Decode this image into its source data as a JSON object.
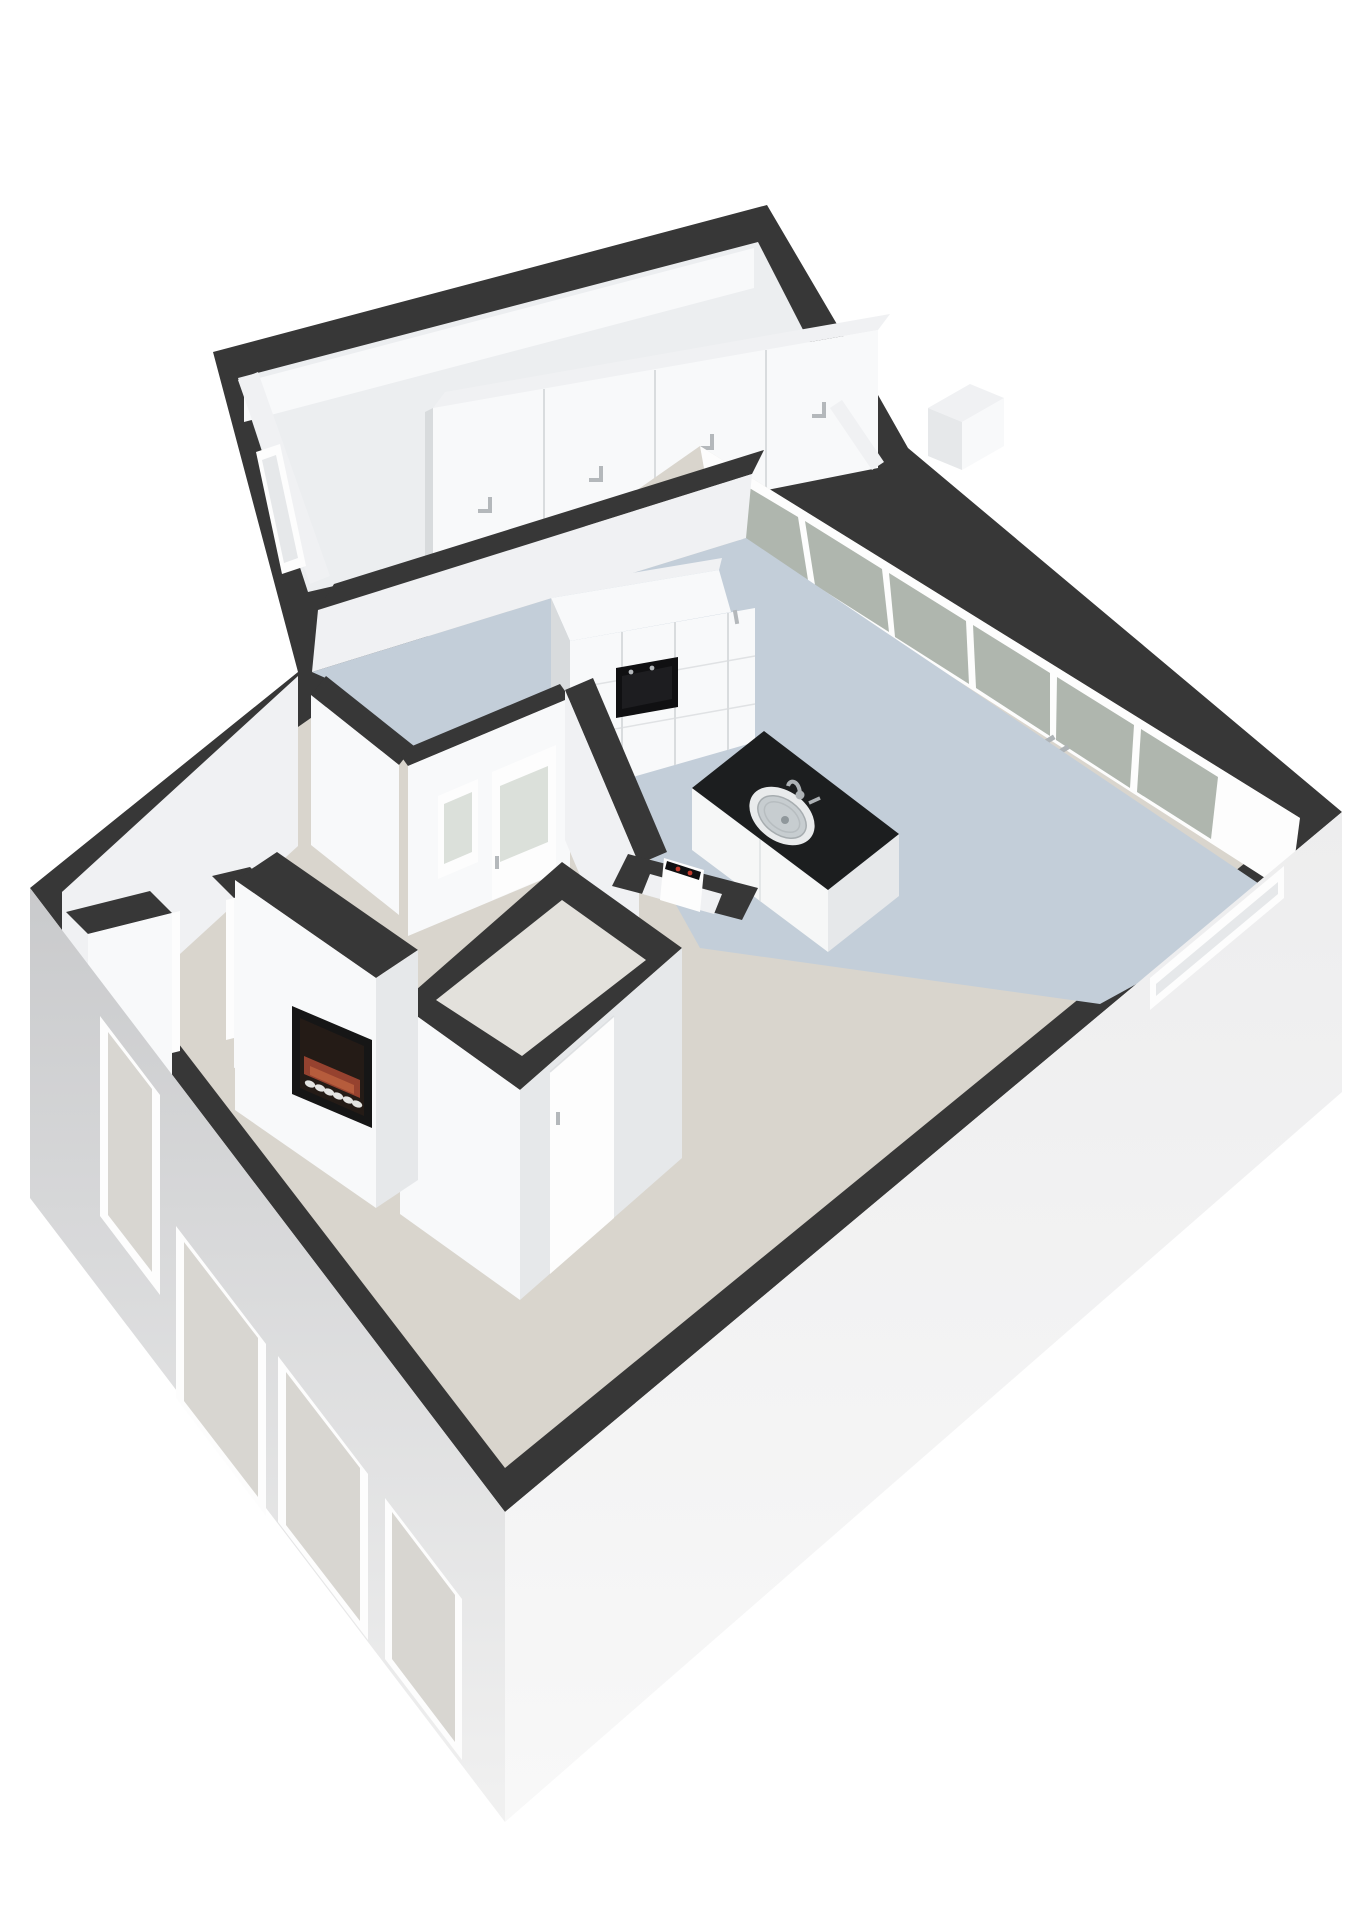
{
  "meta": {
    "render_type": "3d-floorplan-isometric-render",
    "has_text": false
  },
  "colors": {
    "background": "#ffffff",
    "wall_cap": "#373737",
    "wall_face_bright": "#f8f9fa",
    "wall_face_light": "#f0f1f3",
    "wall_face_shade": "#e6e8ea",
    "wall_face_dark": "#d8dbdd",
    "annex_floor": "#eceef0",
    "kitchen_floor": "#c3ced9",
    "living_floor": "#d9d5cd",
    "bath_floor": "#e3e1dc",
    "exterior_wall_top": "#c9cacc",
    "exterior_wall_bottom": "#f1f1f1",
    "exterior_wall_bright": "#f8f8f8",
    "glass_pane": "#afb6ae",
    "window_pane": "#d8d6d1",
    "window_frosted": "#dbe0da",
    "frame_white": "#fdfdfd",
    "seam": "#d9dcde",
    "handle": "#b4b8bb",
    "metal": "#aeb3b6",
    "island_top": "#1c1e1f",
    "island_base": "#f6f7f7",
    "oven_black": "#101012",
    "oven_glass": "#1d1d20",
    "fire_frame": "#161616",
    "fire_inner": "#241b16",
    "fire_flame": "#96422f",
    "fire_flame_hot": "#b65c3c",
    "fire_logs": "#e4e4e2",
    "radiator_red": "#c2392b",
    "sink_rim": "#e9ebec",
    "sink_basin": "#c7cdd0"
  },
  "scene": {
    "objects": [
      {
        "name": "annex-room",
        "items": [
          "wardrobe-with-4-doors",
          "storage-box",
          "side-window"
        ]
      },
      {
        "name": "kitchen",
        "items": [
          "tall-cabinet-with-built-in-oven",
          "cooker-hood-top",
          "island-with-sink-and-faucet",
          "glass-door-wall-6-panels"
        ]
      },
      {
        "name": "hallway",
        "items": [
          "frosted-window",
          "interior-door-with-frosted-glass"
        ]
      },
      {
        "name": "bathroom-block",
        "items": [
          "bathroom-door",
          "radiator-niche-with-red-indicators"
        ]
      },
      {
        "name": "living-room",
        "items": [
          "chimney-breast",
          "recessed-fireplace-with-logs",
          "doorway-opening"
        ]
      },
      {
        "name": "exterior",
        "items": [
          "southwest-wall-4-windows",
          "southeast-wall-slit-window"
        ]
      }
    ],
    "wardrobe_door_count": 4,
    "glass_panel_count": 6,
    "exterior_window_count": 4
  }
}
